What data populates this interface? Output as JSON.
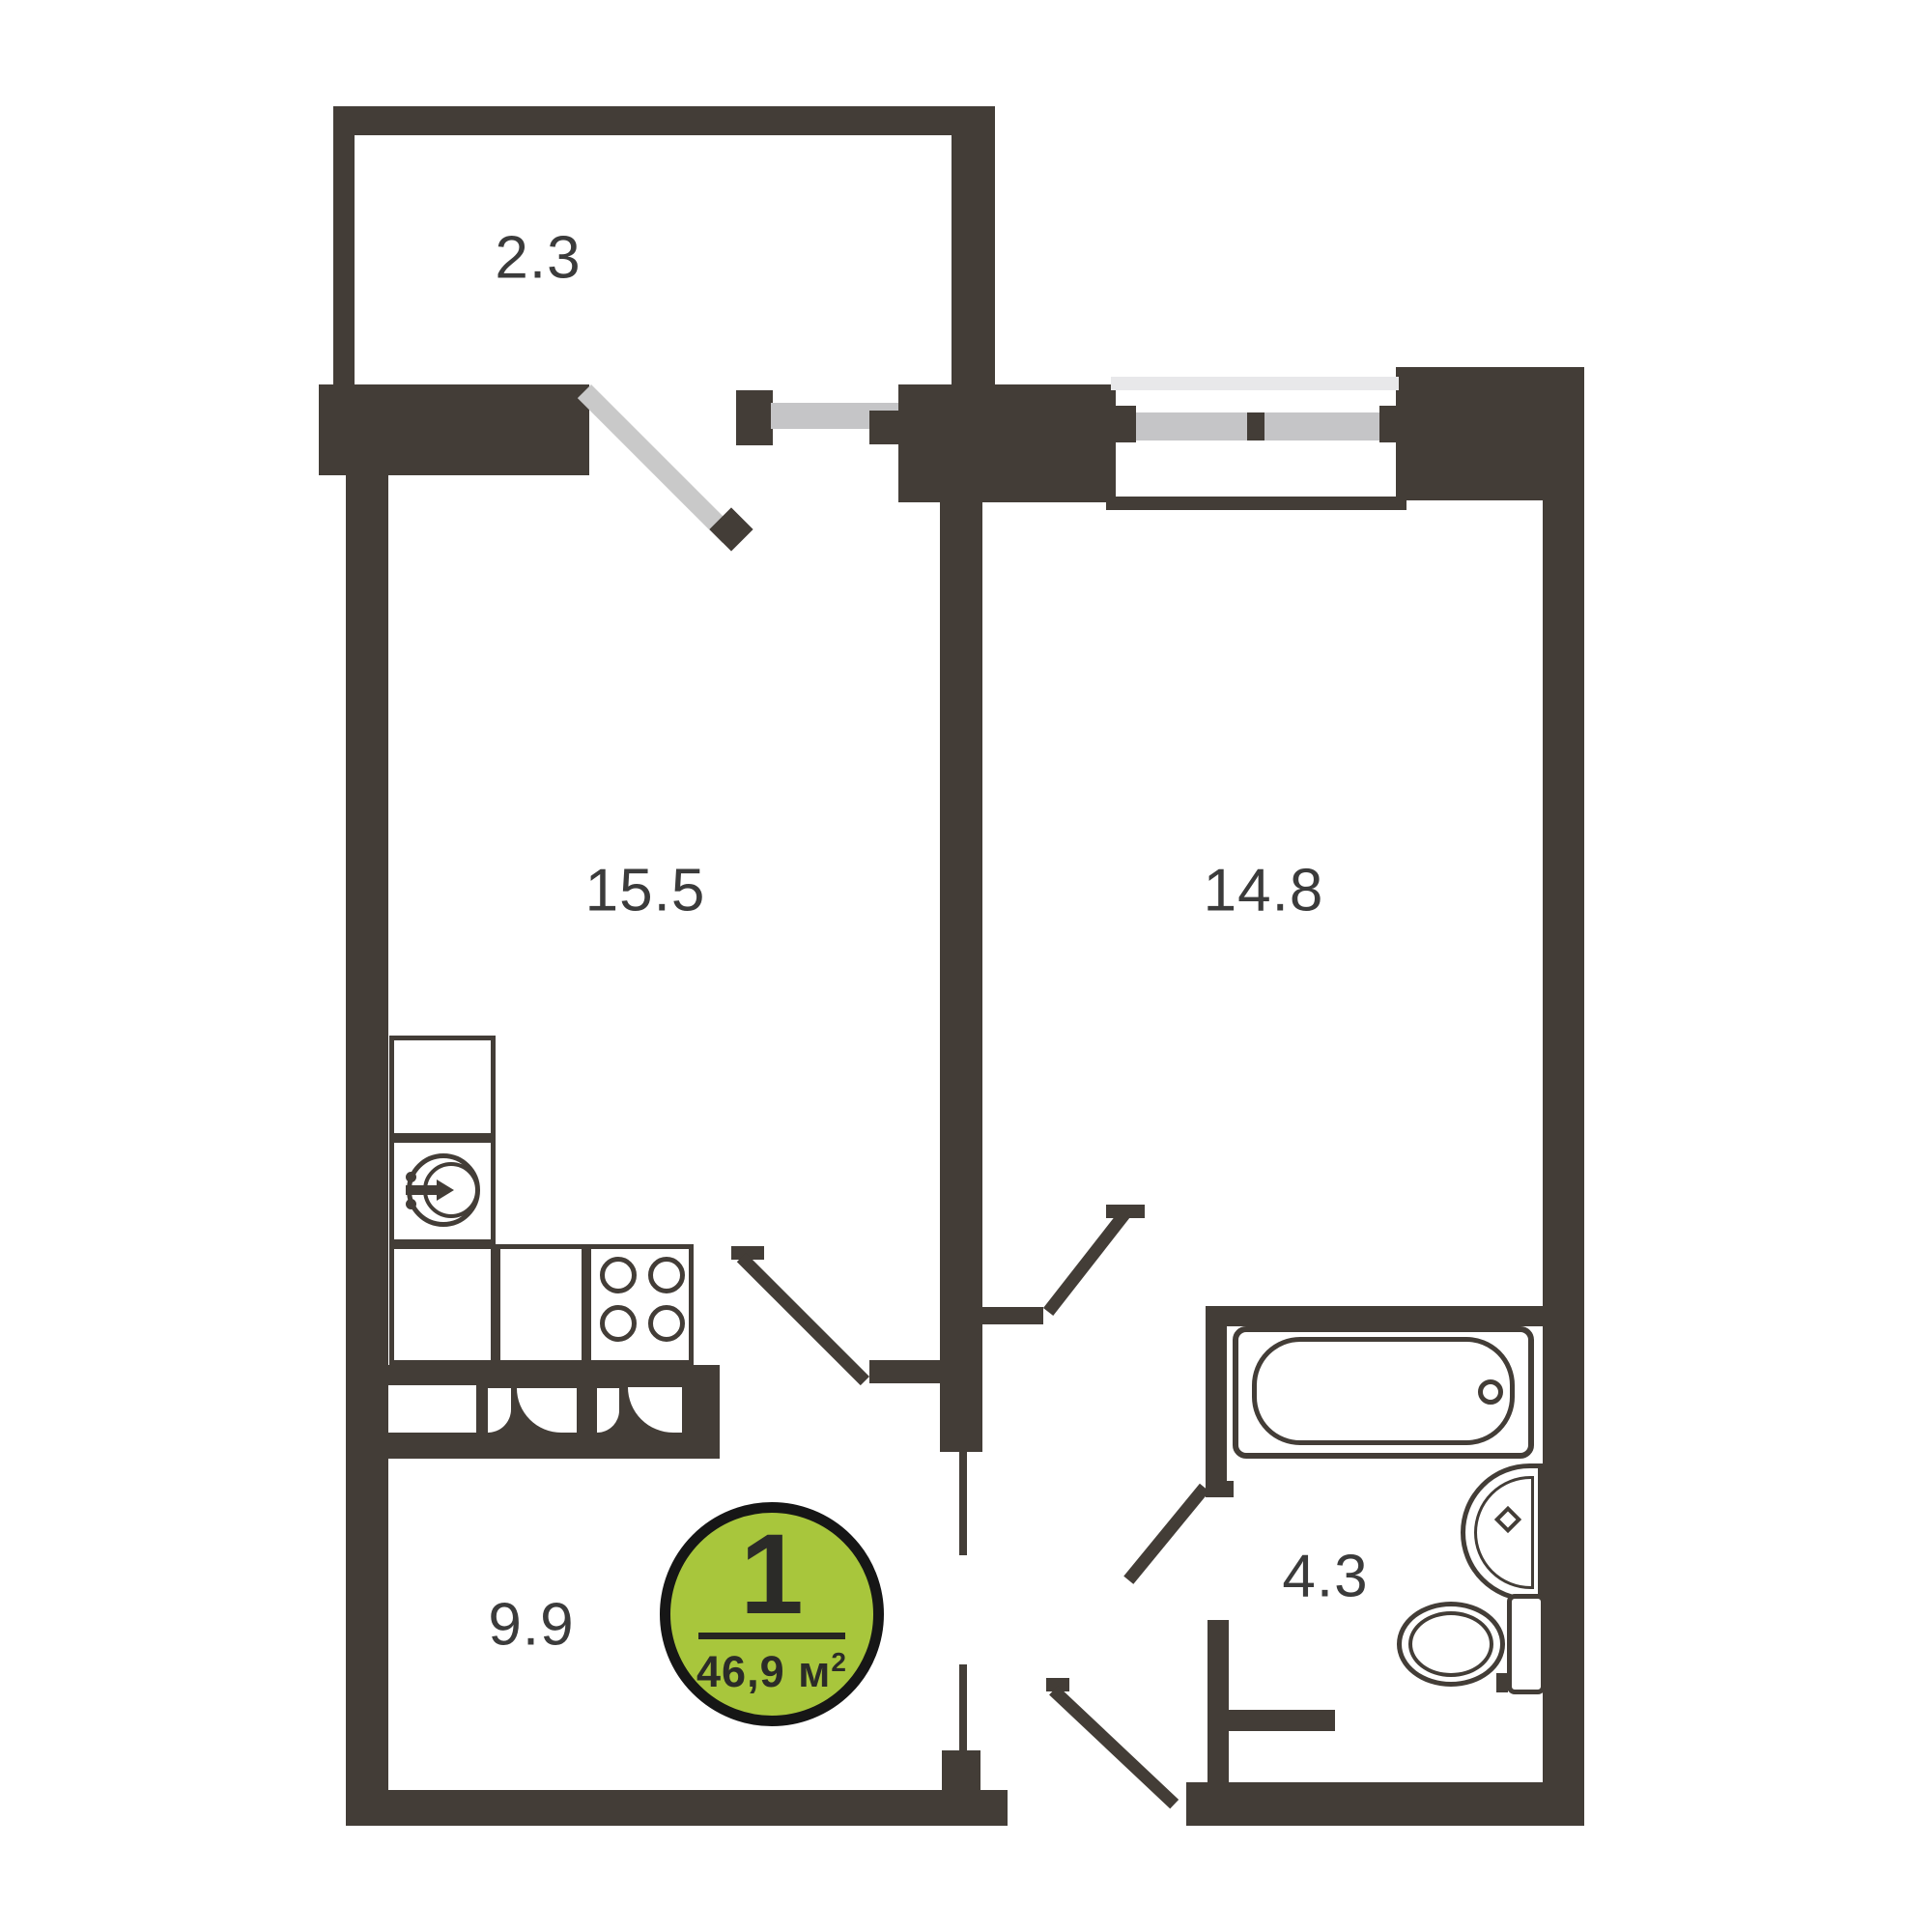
{
  "plan": {
    "type": "apartment-floor-plan",
    "rooms": [
      {
        "id": "balcony",
        "area_label": "2.3"
      },
      {
        "id": "kitchen-living",
        "area_label": "15.5"
      },
      {
        "id": "bedroom",
        "area_label": "14.8"
      },
      {
        "id": "hall",
        "area_label": "9.9"
      },
      {
        "id": "bathroom",
        "area_label": "4.3"
      }
    ],
    "badge": {
      "rooms_count": "1",
      "area_value": "46,9 м",
      "area_sup": "2",
      "fill": "#a8c63c",
      "border": "#161616"
    },
    "colors": {
      "wall": "#433d37",
      "window_light": "#e8e8ea",
      "window_mid": "#c5c5c7",
      "door_leaf": "#c9c9c9"
    },
    "fixtures": [
      "bathtub",
      "washbasin",
      "toilet",
      "kitchen-sink",
      "stove",
      "kitchen-cabinets"
    ]
  }
}
